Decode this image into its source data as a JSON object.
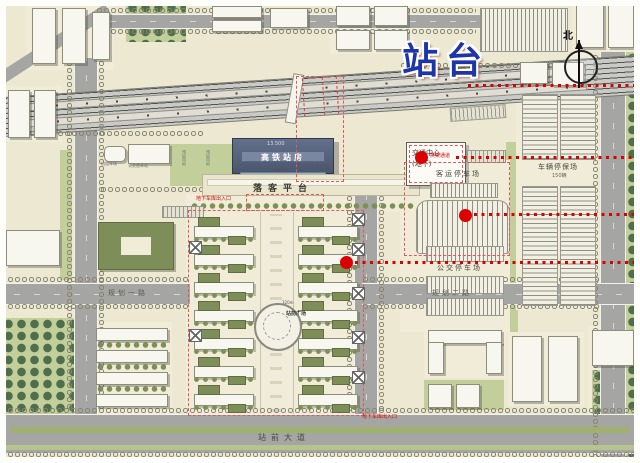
{
  "labels": {
    "platform": "站台",
    "north": "北",
    "station_name": "高铁站房",
    "station_elev": "13.500",
    "dropoff": "落客平台",
    "dropoff_dim": "163m",
    "dropoff_elev": "0.500",
    "traffic_center_l1": "交通中心",
    "traffic_center_l2": "(地下)",
    "callout_transfer": "换乘通道",
    "passenger_parking": "客运停车场",
    "depot": "车辆停保场",
    "depot_cap": "150辆",
    "bus_parking": "公交停车场",
    "plaza": "站前广场",
    "plaza_dim": "320m",
    "avenue": "站前大道",
    "road_west": "规划一路",
    "road_east": "规划二路",
    "garage_west": "地下车库出入口",
    "garage_south": "地下车库出入口",
    "facility_taxi": "出租车场",
    "facility_bus": "公交首末站",
    "reserve_a": "预留用地",
    "reserve_b": "预留用地"
  },
  "colors": {
    "accent_red": "#dd0000",
    "callout_blue": "#1d35a8",
    "station_roof": "#4a566e"
  }
}
